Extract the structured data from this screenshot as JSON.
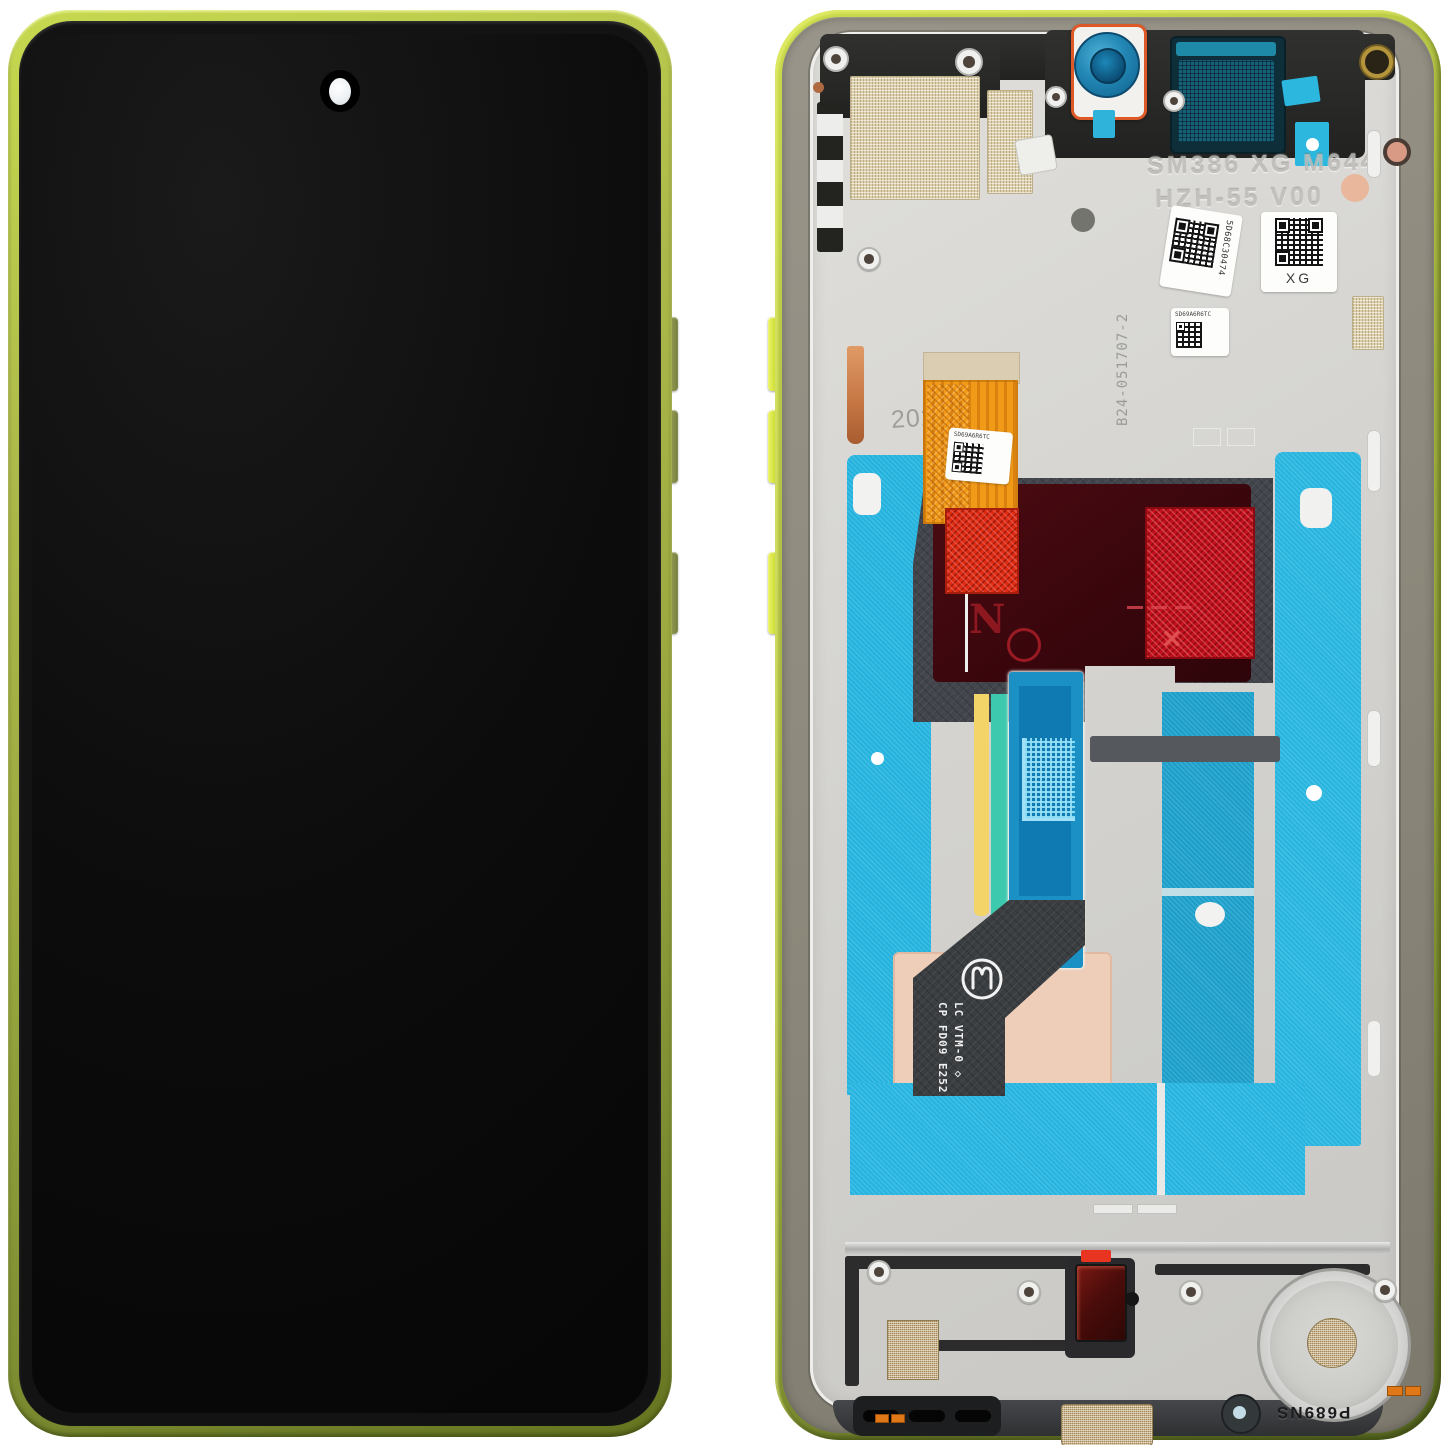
{
  "scene": {
    "description": "Phone LCD display assembly with frame — front and back views on white background",
    "views": [
      "front",
      "back"
    ]
  },
  "back_view": {
    "engraved_line1": "SM386 XG M644",
    "engraved_line2": "HZH-55 V00",
    "qr_label_main": "5D68C30474",
    "qr_label_xg": "XG",
    "qr_label_small": "SD69A6R6TC",
    "flex_label": "SD69A6R6TC",
    "board_code": "B24-051707-2",
    "year_mark": "2025",
    "flex_print_line1": "CP FD09 E252",
    "flex_print_line2": "LC VTM-0 ◇",
    "chassis_code": "P689NS",
    "cross_mark": "✕"
  },
  "icons": {
    "brand_logo": "motorola-batwing-logo"
  },
  "colors": {
    "frame_green": "#a8b44a",
    "frame_green_bright": "#cada4c",
    "frame_olive_dark": "#5b6c23",
    "band_taupe": "#8c887b",
    "metal_silver": "#d3d2ce",
    "adhesive_cyan": "#23b3de",
    "flex_blue": "#1b90c4",
    "flex_orange": "#f09a18",
    "film_red": "#c1101e",
    "film_maroon": "#43090f",
    "shield_gray": "#42454b",
    "mesh_beige": "#ddd0ac",
    "gold_mesh": "#c9b185",
    "pad_pink": "#eecdb9",
    "copper": "#cc8050",
    "strip_yellow": "#f2d468",
    "strip_teal": "#3cc9ae",
    "camera_blue": "#2286b4",
    "screen_black": "#0c0c0c"
  }
}
